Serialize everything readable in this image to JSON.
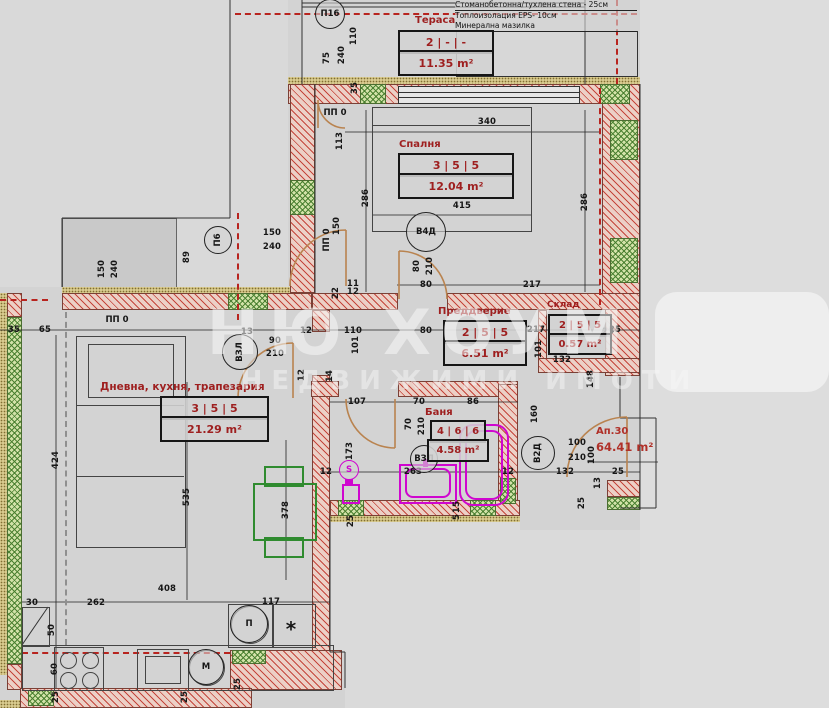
{
  "legend": {
    "lines": [
      "Стоманобетонна/тухлена стена - 25см",
      "Топлоизолация EPS- 10см",
      "Минерална мазилка"
    ]
  },
  "rooms": [
    {
      "name": "Тераса",
      "code": "2 | - | -",
      "area": "11.35 m²"
    },
    {
      "name": "Спалня",
      "code": "3 | 5 | 5",
      "area": "12.04 m²"
    },
    {
      "name": "Преддверие",
      "code": "2 | 5 | 5",
      "area": "6.51 m²"
    },
    {
      "name": "Склад",
      "code": "2 | 5 | 5",
      "area": "0.57 m²"
    },
    {
      "name": "Дневна, кухня, трапезария",
      "code": "3 | 5 | 5",
      "area": "21.29 m²"
    },
    {
      "name": "Баня",
      "code": "4 | 6 | 6",
      "area": "4.58 m²"
    }
  ],
  "apartment": {
    "label": "Ап.30",
    "area": "64.41 m²"
  },
  "watermark": {
    "line1": "НЮ ХОУМ",
    "line2": "НЕДВИЖИМИ ИМОТИ"
  },
  "markers": [
    {
      "t": "П16",
      "x": 330,
      "y": 14,
      "r": 14
    },
    {
      "t": "П6",
      "x": 218,
      "y": 240,
      "r": 13,
      "rot": -90
    },
    {
      "t": "В4Д",
      "x": 426,
      "y": 232,
      "r": 19
    },
    {
      "t": "ВЗЛ",
      "x": 240,
      "y": 352,
      "r": 17,
      "rot": -90
    },
    {
      "t": "ВЗЛ",
      "x": 424,
      "y": 459,
      "r": 13
    },
    {
      "t": "В2Д",
      "x": 538,
      "y": 453,
      "r": 16,
      "rot": -90
    },
    {
      "t": "М",
      "x": 206,
      "y": 667,
      "r": 17
    },
    {
      "t": "П",
      "x": 249,
      "y": 624,
      "r": 18
    },
    {
      "t": "S",
      "x": 349,
      "y": 470,
      "r": 9,
      "mag": true
    },
    {
      "t": "ПП 0",
      "x": 335,
      "y": 113
    },
    {
      "t": "ПП 0",
      "x": 327,
      "y": 240,
      "rot": -90
    },
    {
      "t": "ПП 0",
      "x": 117,
      "y": 320
    },
    {
      "t": "*",
      "x": 291,
      "y": 629,
      "fs": 20
    }
  ],
  "dimensions": [
    {
      "v": "110",
      "x": 354,
      "y": 36,
      "o": "v"
    },
    {
      "v": "240",
      "x": 342,
      "y": 55,
      "o": "v"
    },
    {
      "v": "75",
      "x": 327,
      "y": 58,
      "o": "v"
    },
    {
      "v": "35",
      "x": 355,
      "y": 88,
      "o": "v"
    },
    {
      "v": "113",
      "x": 340,
      "y": 141,
      "o": "v"
    },
    {
      "v": "340",
      "x": 487,
      "y": 122,
      "o": "h"
    },
    {
      "v": "415",
      "x": 462,
      "y": 206,
      "o": "h"
    },
    {
      "v": "286",
      "x": 366,
      "y": 198,
      "o": "v"
    },
    {
      "v": "286",
      "x": 585,
      "y": 202,
      "o": "v"
    },
    {
      "v": "150",
      "x": 272,
      "y": 233,
      "o": "h"
    },
    {
      "v": "240",
      "x": 272,
      "y": 247,
      "o": "h"
    },
    {
      "v": "89",
      "x": 187,
      "y": 257,
      "o": "v"
    },
    {
      "v": "150",
      "x": 102,
      "y": 269,
      "o": "v"
    },
    {
      "v": "240",
      "x": 115,
      "y": 269,
      "o": "v"
    },
    {
      "v": "150",
      "x": 337,
      "y": 226,
      "o": "v"
    },
    {
      "v": "80",
      "x": 417,
      "y": 266,
      "o": "v"
    },
    {
      "v": "210",
      "x": 430,
      "y": 266,
      "o": "v"
    },
    {
      "v": "80",
      "x": 426,
      "y": 285,
      "o": "h"
    },
    {
      "v": "217",
      "x": 532,
      "y": 285,
      "o": "h"
    },
    {
      "v": "11",
      "x": 353,
      "y": 284,
      "o": "h"
    },
    {
      "v": "12",
      "x": 353,
      "y": 292,
      "o": "h"
    },
    {
      "v": "22",
      "x": 336,
      "y": 293,
      "o": "v"
    },
    {
      "v": "35",
      "x": 14,
      "y": 330,
      "o": "h"
    },
    {
      "v": "65",
      "x": 45,
      "y": 330,
      "o": "h"
    },
    {
      "v": "13",
      "x": 247,
      "y": 332,
      "o": "h"
    },
    {
      "v": "12",
      "x": 306,
      "y": 331,
      "o": "h"
    },
    {
      "v": "110",
      "x": 353,
      "y": 331,
      "o": "h"
    },
    {
      "v": "80",
      "x": 426,
      "y": 331,
      "o": "h"
    },
    {
      "v": "217",
      "x": 536,
      "y": 330,
      "o": "h"
    },
    {
      "v": "25",
      "x": 615,
      "y": 330,
      "o": "h"
    },
    {
      "v": "90",
      "x": 275,
      "y": 341,
      "o": "h"
    },
    {
      "v": "210",
      "x": 275,
      "y": 354,
      "o": "h"
    },
    {
      "v": "101",
      "x": 356,
      "y": 345,
      "o": "v"
    },
    {
      "v": "12",
      "x": 302,
      "y": 375,
      "o": "v"
    },
    {
      "v": "14",
      "x": 330,
      "y": 376,
      "o": "v"
    },
    {
      "v": "101",
      "x": 539,
      "y": 349,
      "o": "v"
    },
    {
      "v": "132",
      "x": 562,
      "y": 360,
      "o": "h"
    },
    {
      "v": "148",
      "x": 591,
      "y": 379,
      "o": "v"
    },
    {
      "v": "107",
      "x": 357,
      "y": 402,
      "o": "h"
    },
    {
      "v": "70",
      "x": 419,
      "y": 402,
      "o": "h"
    },
    {
      "v": "86",
      "x": 473,
      "y": 402,
      "o": "h"
    },
    {
      "v": "70",
      "x": 409,
      "y": 424,
      "o": "v"
    },
    {
      "v": "210",
      "x": 422,
      "y": 426,
      "o": "v"
    },
    {
      "v": "173",
      "x": 350,
      "y": 451,
      "o": "v"
    },
    {
      "v": "263",
      "x": 413,
      "y": 472,
      "o": "h"
    },
    {
      "v": "12",
      "x": 326,
      "y": 472,
      "o": "h"
    },
    {
      "v": "15",
      "x": 457,
      "y": 507,
      "o": "v"
    },
    {
      "v": "5",
      "x": 457,
      "y": 517,
      "o": "v"
    },
    {
      "v": "25",
      "x": 351,
      "y": 521,
      "o": "v"
    },
    {
      "v": "160",
      "x": 535,
      "y": 414,
      "o": "v"
    },
    {
      "v": "100",
      "x": 577,
      "y": 443,
      "o": "h"
    },
    {
      "v": "210",
      "x": 577,
      "y": 458,
      "o": "h"
    },
    {
      "v": "132",
      "x": 565,
      "y": 472,
      "o": "h"
    },
    {
      "v": "12",
      "x": 508,
      "y": 472,
      "o": "h"
    },
    {
      "v": "100",
      "x": 592,
      "y": 455,
      "o": "v"
    },
    {
      "v": "13",
      "x": 598,
      "y": 483,
      "o": "v"
    },
    {
      "v": "25",
      "x": 618,
      "y": 472,
      "o": "h"
    },
    {
      "v": "25",
      "x": 582,
      "y": 503,
      "o": "v"
    },
    {
      "v": "25",
      "x": 608,
      "y": 332,
      "o": "h"
    },
    {
      "v": "424",
      "x": 56,
      "y": 460,
      "o": "v"
    },
    {
      "v": "535",
      "x": 187,
      "y": 497,
      "o": "v"
    },
    {
      "v": "378",
      "x": 286,
      "y": 510,
      "o": "v"
    },
    {
      "v": "408",
      "x": 167,
      "y": 589,
      "o": "h"
    },
    {
      "v": "30",
      "x": 32,
      "y": 603,
      "o": "h"
    },
    {
      "v": "262",
      "x": 96,
      "y": 603,
      "o": "h"
    },
    {
      "v": "117",
      "x": 271,
      "y": 602,
      "o": "h"
    },
    {
      "v": "50",
      "x": 52,
      "y": 630,
      "o": "v"
    },
    {
      "v": "60",
      "x": 55,
      "y": 669,
      "o": "v"
    },
    {
      "v": "25",
      "x": 56,
      "y": 697,
      "o": "v"
    },
    {
      "v": "25",
      "x": 185,
      "y": 697,
      "o": "v"
    },
    {
      "v": "25",
      "x": 238,
      "y": 684,
      "o": "v"
    }
  ]
}
